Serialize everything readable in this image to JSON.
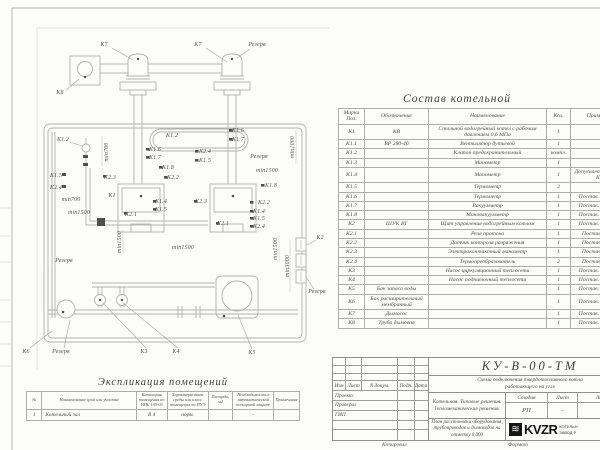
{
  "plan": {
    "labels": [
      {
        "t": "К7",
        "x": 104,
        "y": 45
      },
      {
        "t": "К7",
        "x": 198,
        "y": 45
      },
      {
        "t": "Резерв",
        "x": 257,
        "y": 45
      },
      {
        "t": "К8",
        "x": 60,
        "y": 93
      },
      {
        "t": "К1.2",
        "x": 63,
        "y": 140
      },
      {
        "t": "min700",
        "x": 107,
        "y": 152,
        "r": 1
      },
      {
        "t": "К1.5",
        "x": 56,
        "y": 176
      },
      {
        "t": "К2.4",
        "x": 56,
        "y": 188
      },
      {
        "t": "min700",
        "x": 71,
        "y": 200
      },
      {
        "t": "min1500",
        "x": 79,
        "y": 213
      },
      {
        "t": "К2.3",
        "x": 110,
        "y": 178
      },
      {
        "t": "К1",
        "x": 112,
        "y": 196
      },
      {
        "t": "К2.1",
        "x": 131,
        "y": 215
      },
      {
        "t": "К1.4",
        "x": 161,
        "y": 202
      },
      {
        "t": "К1.5",
        "x": 161,
        "y": 210
      },
      {
        "t": "К1.2",
        "x": 172,
        "y": 136
      },
      {
        "t": "К1.6",
        "x": 155,
        "y": 150
      },
      {
        "t": "К1.7",
        "x": 155,
        "y": 158
      },
      {
        "t": "К1.8",
        "x": 168,
        "y": 168
      },
      {
        "t": "К2.2",
        "x": 173,
        "y": 178
      },
      {
        "t": "К2.4",
        "x": 205,
        "y": 152
      },
      {
        "t": "К1.5",
        "x": 205,
        "y": 161
      },
      {
        "t": "К1.6",
        "x": 238,
        "y": 131
      },
      {
        "t": "К1.7",
        "x": 238,
        "y": 140
      },
      {
        "t": "Резерв",
        "x": 259,
        "y": 157
      },
      {
        "t": "min1000",
        "x": 293,
        "y": 147,
        "r": 1
      },
      {
        "t": "min1500",
        "x": 267,
        "y": 171
      },
      {
        "t": "К1.8",
        "x": 271,
        "y": 186
      },
      {
        "t": "К2.2",
        "x": 264,
        "y": 203
      },
      {
        "t": "К1.4",
        "x": 259,
        "y": 212
      },
      {
        "t": "К1.5",
        "x": 259,
        "y": 219
      },
      {
        "t": "К2.4",
        "x": 259,
        "y": 227
      },
      {
        "t": "К2.1",
        "x": 223,
        "y": 224
      },
      {
        "t": "К2.3",
        "x": 201,
        "y": 202
      },
      {
        "t": "min1500",
        "x": 120,
        "y": 242,
        "r": 1
      },
      {
        "t": "min1500",
        "x": 183,
        "y": 248
      },
      {
        "t": "Резерв",
        "x": 64,
        "y": 261
      },
      {
        "t": "min1500",
        "x": 276,
        "y": 249,
        "r": 1
      },
      {
        "t": "min3000",
        "x": 288,
        "y": 266,
        "r": 1
      },
      {
        "t": "К2",
        "x": 320,
        "y": 238
      },
      {
        "t": "Резерв",
        "x": 317,
        "y": 292
      },
      {
        "t": "К6",
        "x": 26,
        "y": 352
      },
      {
        "t": "Резерв",
        "x": 61,
        "y": 352
      },
      {
        "t": "К3",
        "x": 144,
        "y": 352
      },
      {
        "t": "К4",
        "x": 176,
        "y": 352
      },
      {
        "t": "К5",
        "x": 252,
        "y": 353
      }
    ]
  },
  "composition": {
    "title": "Состав котельной",
    "columns": [
      "Марка Поз.",
      "Обозначение",
      "Наименование",
      "Кол.",
      "Примечание"
    ],
    "rows": [
      [
        "К1",
        "КВ",
        "Стальной водогрейный котел с рабочим давлением 0,6 МПа",
        "1",
        ""
      ],
      [
        "К1.1",
        "ВР 280-46",
        "Вентилятор дутьевой",
        "1",
        ""
      ],
      [
        "К1.2",
        "",
        "Клапан предохранительный",
        "компл.",
        ""
      ],
      [
        "К1.3",
        "",
        "Манометр",
        "1",
        ""
      ],
      [
        "К1.4",
        "",
        "Манометр",
        "1",
        "Допускается зам. поз. К2.3"
      ],
      [
        "К1.5",
        "",
        "Термометр",
        "2",
        ""
      ],
      [
        "К1.6",
        "",
        "Термометр",
        "1",
        "Постав. по соглас."
      ],
      [
        "К1.7",
        "",
        "Вакуумметр",
        "1",
        "Постав. по соглас."
      ],
      [
        "К1.8",
        "",
        "Мановакуумметр",
        "1",
        "Постав. по соглас."
      ],
      [
        "К2",
        "ШУК ВТ",
        "Щит управления водогрейным котлом",
        "1",
        "Постав. по соглас."
      ],
      [
        "К2.1",
        "",
        "Реле протока",
        "1",
        "Постав. с ШУК"
      ],
      [
        "К2.2",
        "",
        "Датчик контроля разряжения",
        "1",
        "Постав. с ШУК"
      ],
      [
        "К2.3",
        "",
        "Электроконтактный манометр",
        "1",
        "Постав. с ШУК"
      ],
      [
        "К2.4",
        "",
        "Термопреобразователь",
        "2",
        "Постав. с ШУК"
      ],
      [
        "К3",
        "",
        "Насос циркуляционный теплосети",
        "1",
        "Постав. по соглас."
      ],
      [
        "К4",
        "",
        "Насос подпиточный теплосети",
        "1",
        "Постав. по соглас."
      ],
      [
        "К5",
        "Бак запаса воды",
        "",
        "1",
        "Постав. по соглас."
      ],
      [
        "К6",
        "Бак расширительный мембранный",
        "",
        "1",
        "Постав. по соглас."
      ],
      [
        "К7",
        "Дымосос",
        "",
        "1",
        "Постав. по соглас."
      ],
      [
        "К8",
        "Труба дымовая",
        "",
        "1",
        "Постав. по соглас."
      ]
    ]
  },
  "explication": {
    "title": "Экспликация помещений",
    "columns": [
      "№",
      "Наименование цеха или участка",
      "Категория помещения по НПБ 105-03",
      "Характеристика среды или класс помещения по ПУЭ",
      "Площадь, м2",
      "Необходимость в автоматической пожарной защите",
      "Примечание"
    ],
    "rows": [
      [
        "1",
        "Котельный зал",
        "В 4",
        "норм.",
        "",
        "-",
        ""
      ]
    ]
  },
  "titleblock": {
    "code": "КУ-В-00-ТМ",
    "doc_title": "Схема подключения твердотопливного котла работающего на угле",
    "org_line1": "Котельная. Типовые решения.",
    "org_line2": "Тепломеханические решения.",
    "sheet_title": "План расстановки оборудования, трубопроводов и дымоходов на отметку 0,000",
    "stage_label": "Стадия",
    "sheet_label": "Лист",
    "sheets_label": "Листов",
    "stage": "РП",
    "sheet_no": "-",
    "sheets": "-",
    "cols": [
      "Изм",
      "Лист",
      "N докум.",
      "Подп.",
      "Дата"
    ],
    "roles": [
      "Проект.",
      "Проверил",
      "ГИП"
    ],
    "logo_mark": "≋",
    "logo": "KVZR",
    "logo_sub1": "КОТЕЛЬН",
    "logo_sub2": "ЗАВОД Р",
    "copied": "Копировал",
    "format": "Формат"
  }
}
